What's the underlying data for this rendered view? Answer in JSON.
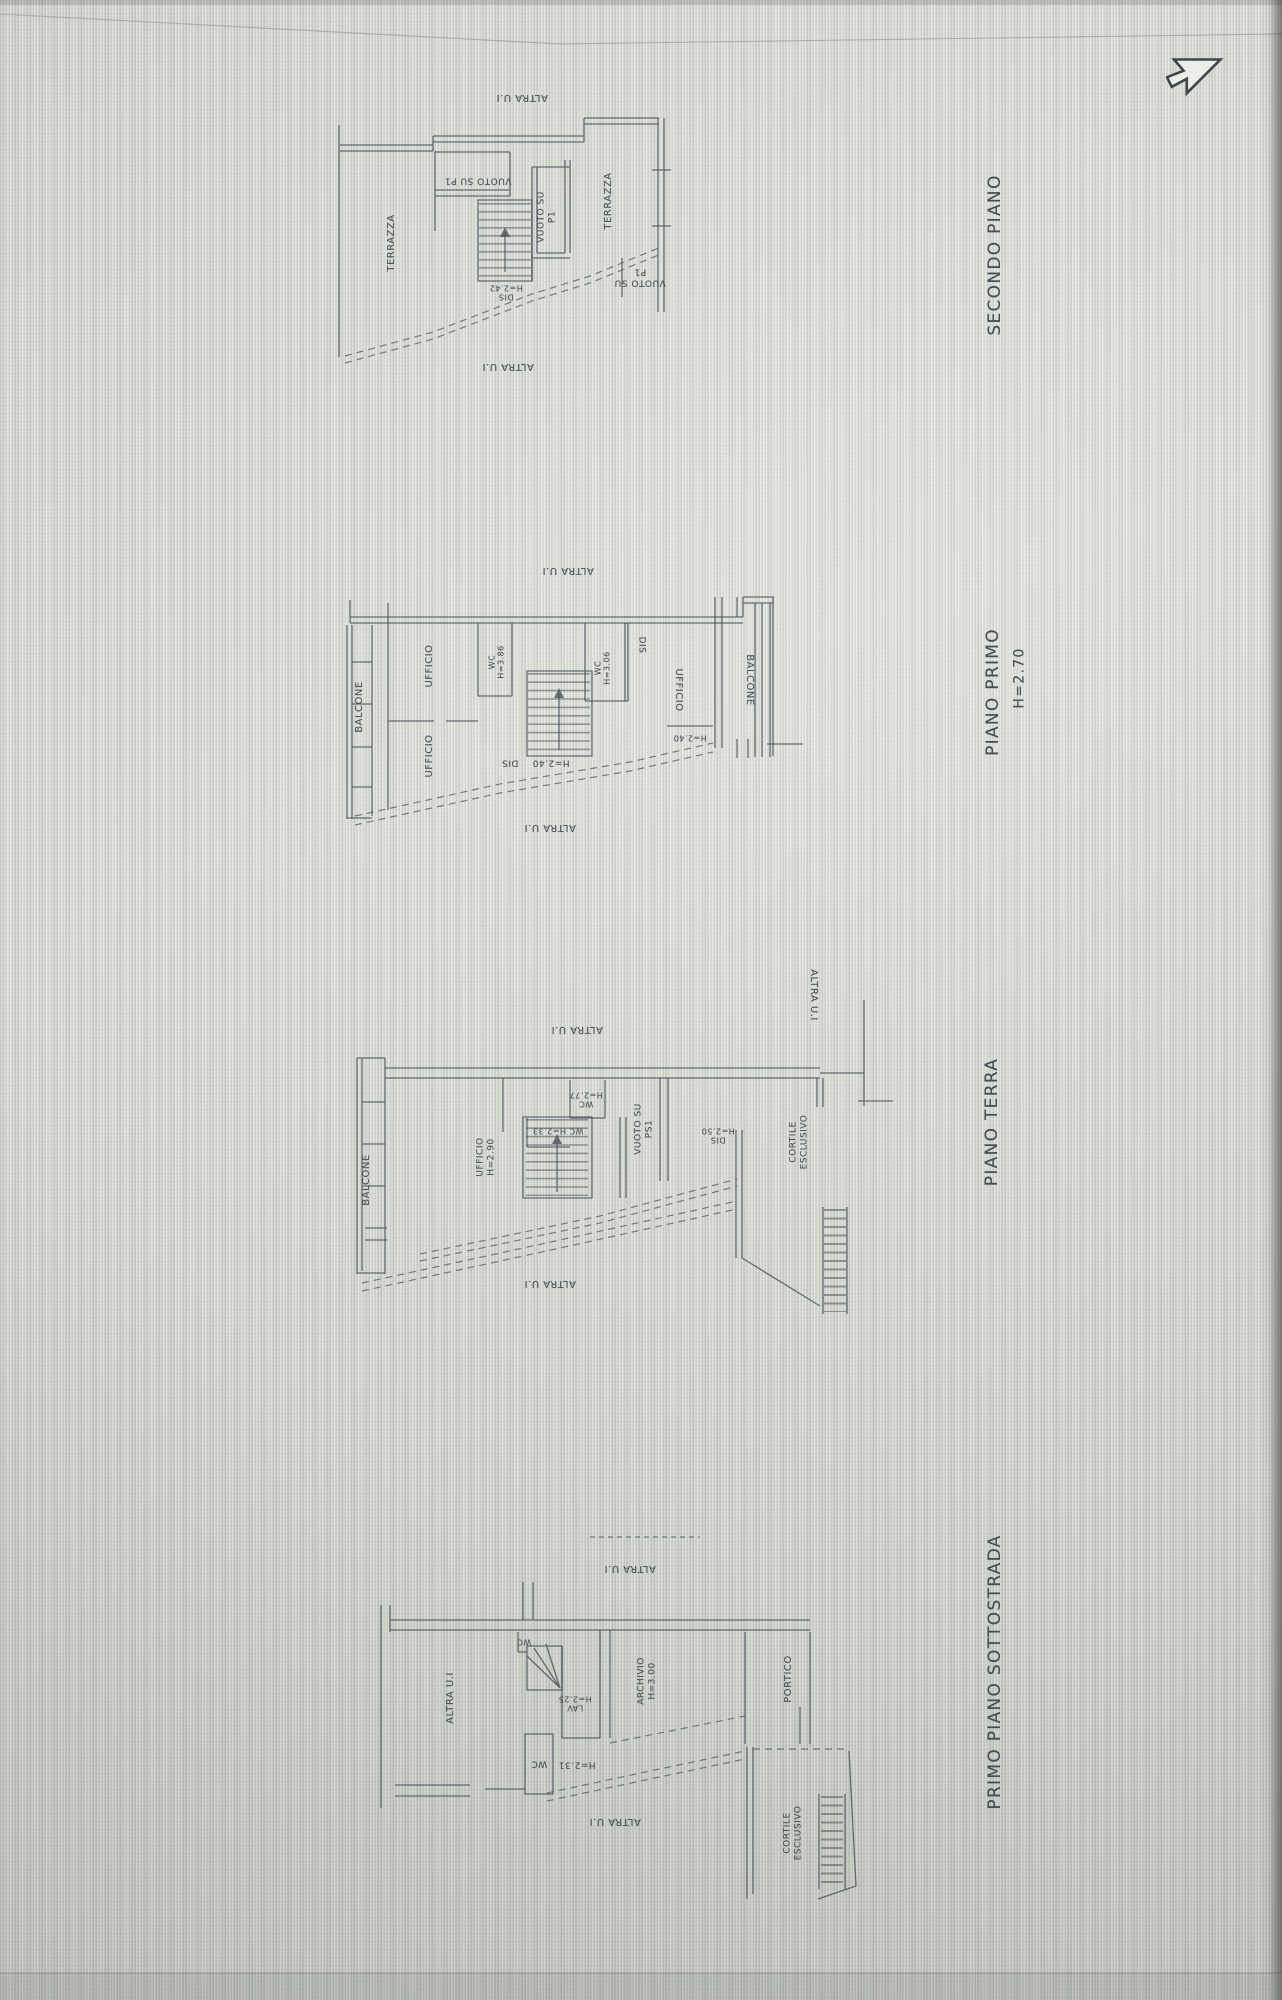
{
  "colors": {
    "line": "#4d525a",
    "label": "#3d424a",
    "background": "#dadcd6",
    "screen_edge": "#3c3e3a"
  },
  "cursor": {
    "icon": "arrow-cursor"
  },
  "plans": [
    {
      "id": "secondo",
      "title": {
        "text": "SECONDO PIANO",
        "x": 995,
        "y": 255,
        "rot": -90,
        "size": 17
      },
      "labels": [
        {
          "text": "ALTRA U.I",
          "x": 522,
          "y": 97,
          "rot": 180,
          "size": 10,
          "kind": "boundary"
        },
        {
          "text": "TERRAZZA",
          "x": 392,
          "y": 243,
          "rot": -90,
          "size": 10,
          "kind": "room"
        },
        {
          "text": "VUOTO SU P1",
          "x": 478,
          "y": 180,
          "rot": 180,
          "size": 9,
          "kind": "room"
        },
        {
          "text": "VUOTO SU\nP1",
          "x": 547,
          "y": 217,
          "rot": -90,
          "size": 9,
          "kind": "room"
        },
        {
          "text": "TERRAZZA",
          "x": 609,
          "y": 201,
          "rot": -90,
          "size": 10,
          "kind": "room"
        },
        {
          "text": "VUOTO SU\nP1",
          "x": 640,
          "y": 277,
          "rot": 180,
          "size": 9,
          "kind": "room"
        },
        {
          "text": "DIS\nH=2.42",
          "x": 506,
          "y": 292,
          "rot": 180,
          "size": 8,
          "kind": "dim"
        },
        {
          "text": "ALTRA U.I",
          "x": 508,
          "y": 366,
          "rot": 180,
          "size": 10,
          "kind": "boundary"
        }
      ]
    },
    {
      "id": "primo",
      "title": {
        "text": "PIANO PRIMO",
        "x": 993,
        "y": 692,
        "rot": -90,
        "size": 17
      },
      "subtitle": {
        "text": "H=2.70",
        "x": 1020,
        "y": 678,
        "rot": -90,
        "size": 14
      },
      "labels": [
        {
          "text": "ALTRA U.I",
          "x": 568,
          "y": 570,
          "rot": 180,
          "size": 10,
          "kind": "boundary"
        },
        {
          "text": "BALCONE",
          "x": 360,
          "y": 707,
          "rot": -90,
          "size": 10,
          "kind": "room"
        },
        {
          "text": "UFFICIO",
          "x": 430,
          "y": 666,
          "rot": -90,
          "size": 10,
          "kind": "room"
        },
        {
          "text": "UFFICIO",
          "x": 430,
          "y": 756,
          "rot": -90,
          "size": 10,
          "kind": "room"
        },
        {
          "text": "WC\nH=3.86",
          "x": 497,
          "y": 662,
          "rot": -90,
          "size": 8,
          "kind": "dim"
        },
        {
          "text": "DIS",
          "x": 510,
          "y": 762,
          "rot": 180,
          "size": 9,
          "kind": "room"
        },
        {
          "text": "H=2.40",
          "x": 551,
          "y": 762,
          "rot": 180,
          "size": 9,
          "kind": "dim"
        },
        {
          "text": "WC\nH=3.06",
          "x": 603,
          "y": 668,
          "rot": -90,
          "size": 8,
          "kind": "dim"
        },
        {
          "text": "DIS",
          "x": 641,
          "y": 645,
          "rot": 90,
          "size": 9,
          "kind": "room"
        },
        {
          "text": "UFFICIO",
          "x": 678,
          "y": 690,
          "rot": 90,
          "size": 10,
          "kind": "room"
        },
        {
          "text": "H=2.40",
          "x": 690,
          "y": 738,
          "rot": 180,
          "size": 8,
          "kind": "dim"
        },
        {
          "text": "BALCONE",
          "x": 749,
          "y": 680,
          "rot": 90,
          "size": 10,
          "kind": "room"
        },
        {
          "text": "ALTRA U.I",
          "x": 550,
          "y": 827,
          "rot": 180,
          "size": 10,
          "kind": "boundary"
        }
      ]
    },
    {
      "id": "terra",
      "title": {
        "text": "PIANO TERRA",
        "x": 992,
        "y": 1122,
        "rot": -90,
        "size": 17
      },
      "labels": [
        {
          "text": "ALTRA U.I",
          "x": 577,
          "y": 1029,
          "rot": 180,
          "size": 10,
          "kind": "boundary"
        },
        {
          "text": "ALTRA U.I",
          "x": 813,
          "y": 995,
          "rot": 90,
          "size": 10,
          "kind": "boundary"
        },
        {
          "text": "BALCONE",
          "x": 367,
          "y": 1180,
          "rot": -90,
          "size": 10,
          "kind": "room"
        },
        {
          "text": "UFFICIO\nH=2.90",
          "x": 486,
          "y": 1157,
          "rot": -90,
          "size": 9,
          "kind": "room"
        },
        {
          "text": "WC\nH=2.77",
          "x": 586,
          "y": 1099,
          "rot": 180,
          "size": 8,
          "kind": "dim"
        },
        {
          "text": "WC H=2.33",
          "x": 558,
          "y": 1131,
          "rot": 180,
          "size": 8,
          "kind": "dim"
        },
        {
          "text": "VUOTO SU\nPS1",
          "x": 644,
          "y": 1129,
          "rot": -90,
          "size": 9,
          "kind": "room"
        },
        {
          "text": "DIS\nH=2.50",
          "x": 718,
          "y": 1135,
          "rot": 180,
          "size": 8,
          "kind": "dim"
        },
        {
          "text": "CORTILE\nESCLUSIVO",
          "x": 799,
          "y": 1142,
          "rot": -90,
          "size": 9,
          "kind": "room"
        },
        {
          "text": "ALTRA U.I",
          "x": 550,
          "y": 1283,
          "rot": 180,
          "size": 10,
          "kind": "boundary"
        }
      ]
    },
    {
      "id": "sottostrada",
      "title": {
        "text": "PRIMO PIANO SOTTOSTRADA",
        "x": 995,
        "y": 1672,
        "rot": -90,
        "size": 17
      },
      "labels": [
        {
          "text": "ALTRA U.I",
          "x": 630,
          "y": 1568,
          "rot": 180,
          "size": 10,
          "kind": "boundary"
        },
        {
          "text": "ALTRA U.I",
          "x": 451,
          "y": 1698,
          "rot": -90,
          "size": 10,
          "kind": "boundary"
        },
        {
          "text": "WC",
          "x": 524,
          "y": 1642,
          "rot": 180,
          "size": 8,
          "kind": "room"
        },
        {
          "text": "LAV\nH=2.25",
          "x": 575,
          "y": 1703,
          "rot": 180,
          "size": 8,
          "kind": "dim"
        },
        {
          "text": "ARCHIVIO\nH=3.00",
          "x": 647,
          "y": 1681,
          "rot": -90,
          "size": 9,
          "kind": "room"
        },
        {
          "text": "PORTICO",
          "x": 789,
          "y": 1679,
          "rot": -90,
          "size": 10,
          "kind": "room"
        },
        {
          "text": "WC",
          "x": 539,
          "y": 1763,
          "rot": 180,
          "size": 9,
          "kind": "room"
        },
        {
          "text": "H=2.31",
          "x": 577,
          "y": 1764,
          "rot": 180,
          "size": 9,
          "kind": "dim"
        },
        {
          "text": "ALTRA U.I",
          "x": 615,
          "y": 1821,
          "rot": 180,
          "size": 10,
          "kind": "boundary"
        },
        {
          "text": "CORTILE\nESCLUSIVO",
          "x": 793,
          "y": 1833,
          "rot": -90,
          "size": 9,
          "kind": "room"
        }
      ]
    }
  ]
}
